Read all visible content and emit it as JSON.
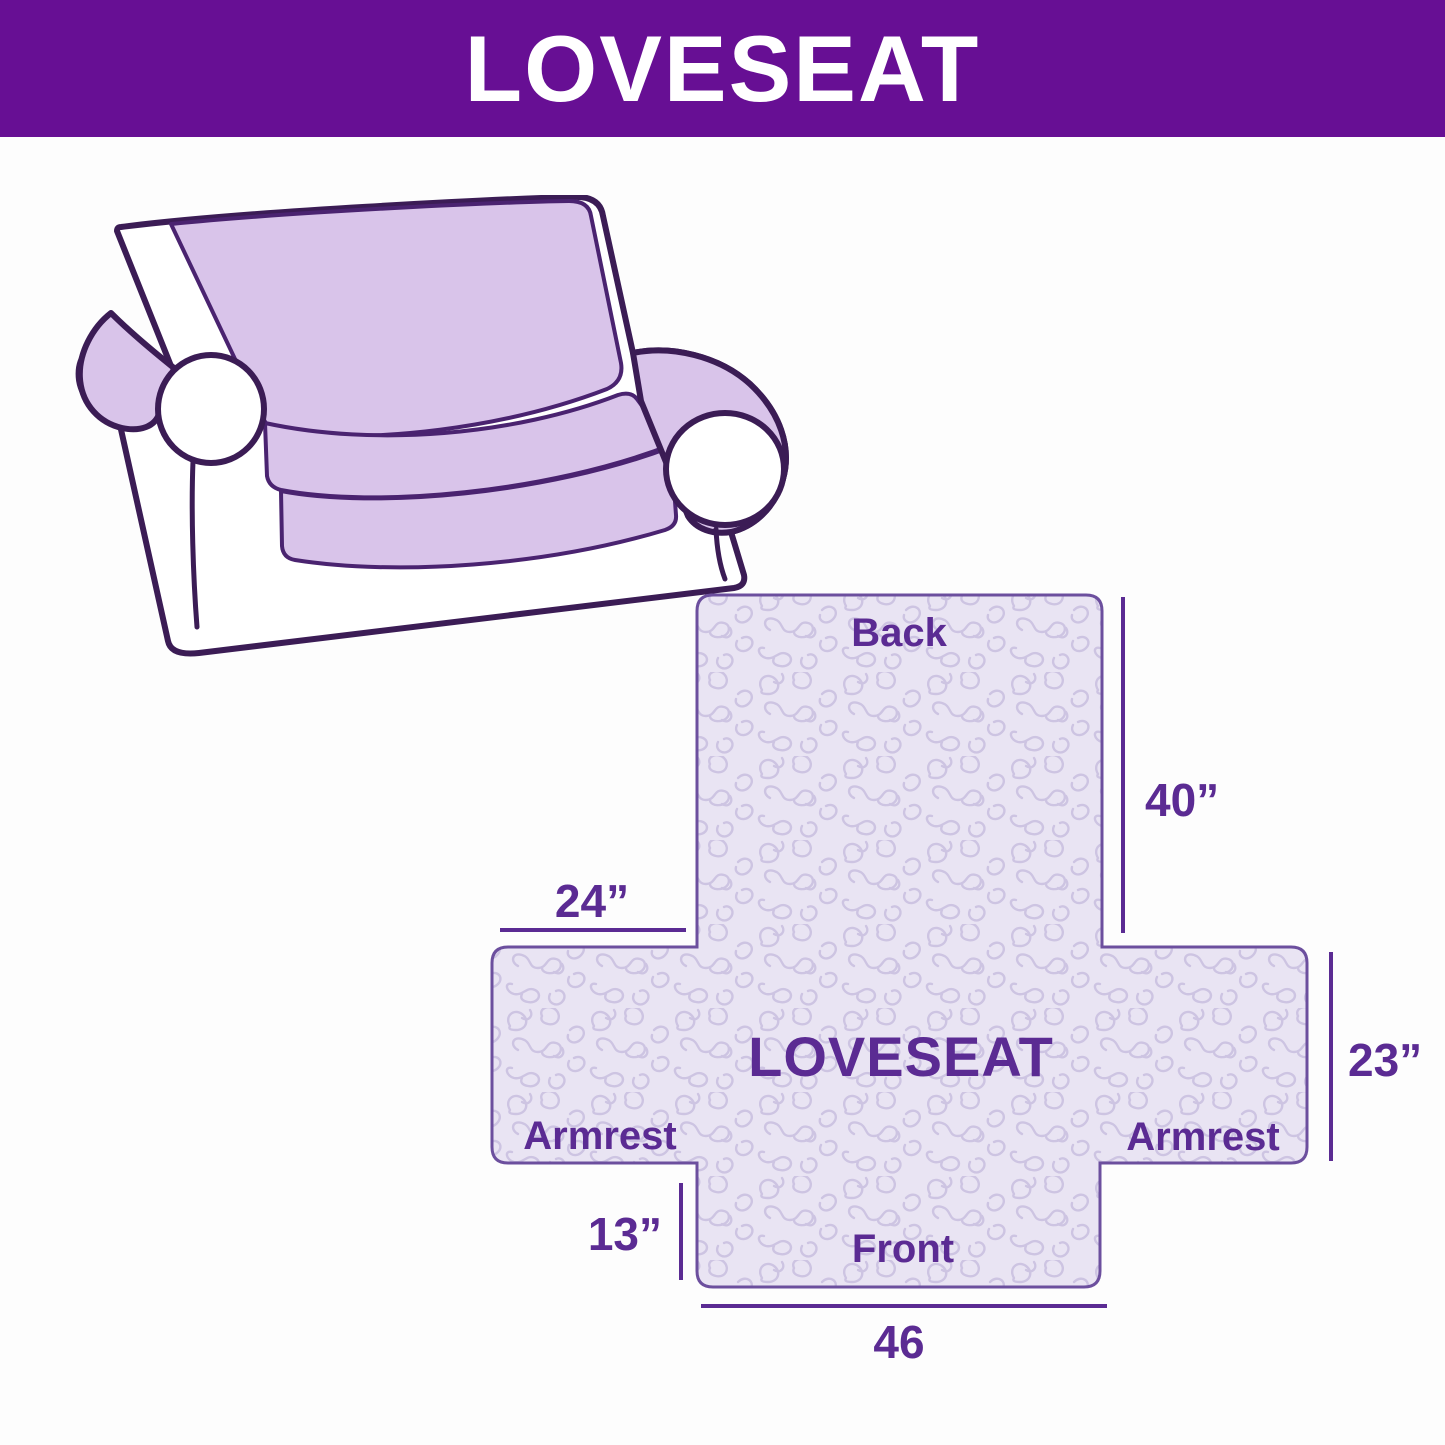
{
  "header": {
    "title": "LOVESEAT"
  },
  "illustration": {
    "description": "line drawing of a two-seat loveseat sofa with a light purple slipcover on back, seat and armrest tops",
    "cover_color": "#D9C4EA",
    "outline_color": "#3B1C55"
  },
  "diagram": {
    "center_label": "LOVESEAT",
    "panel_labels": {
      "back": "Back",
      "front": "Front",
      "armrest_left": "Armrest",
      "armrest_right": "Armrest"
    },
    "dimensions": {
      "back_height": "40”",
      "armrest_top_width": "24”",
      "armrest_height": "23”",
      "front_skirt_height": "13”",
      "front_width": "46"
    },
    "colors": {
      "banner_purple": "#670F94",
      "label_purple": "#5B2B93",
      "quilt_fill": "#E9E4F3",
      "quilt_pattern": "#CDC4E2",
      "shape_border": "#6C4F9E"
    }
  }
}
